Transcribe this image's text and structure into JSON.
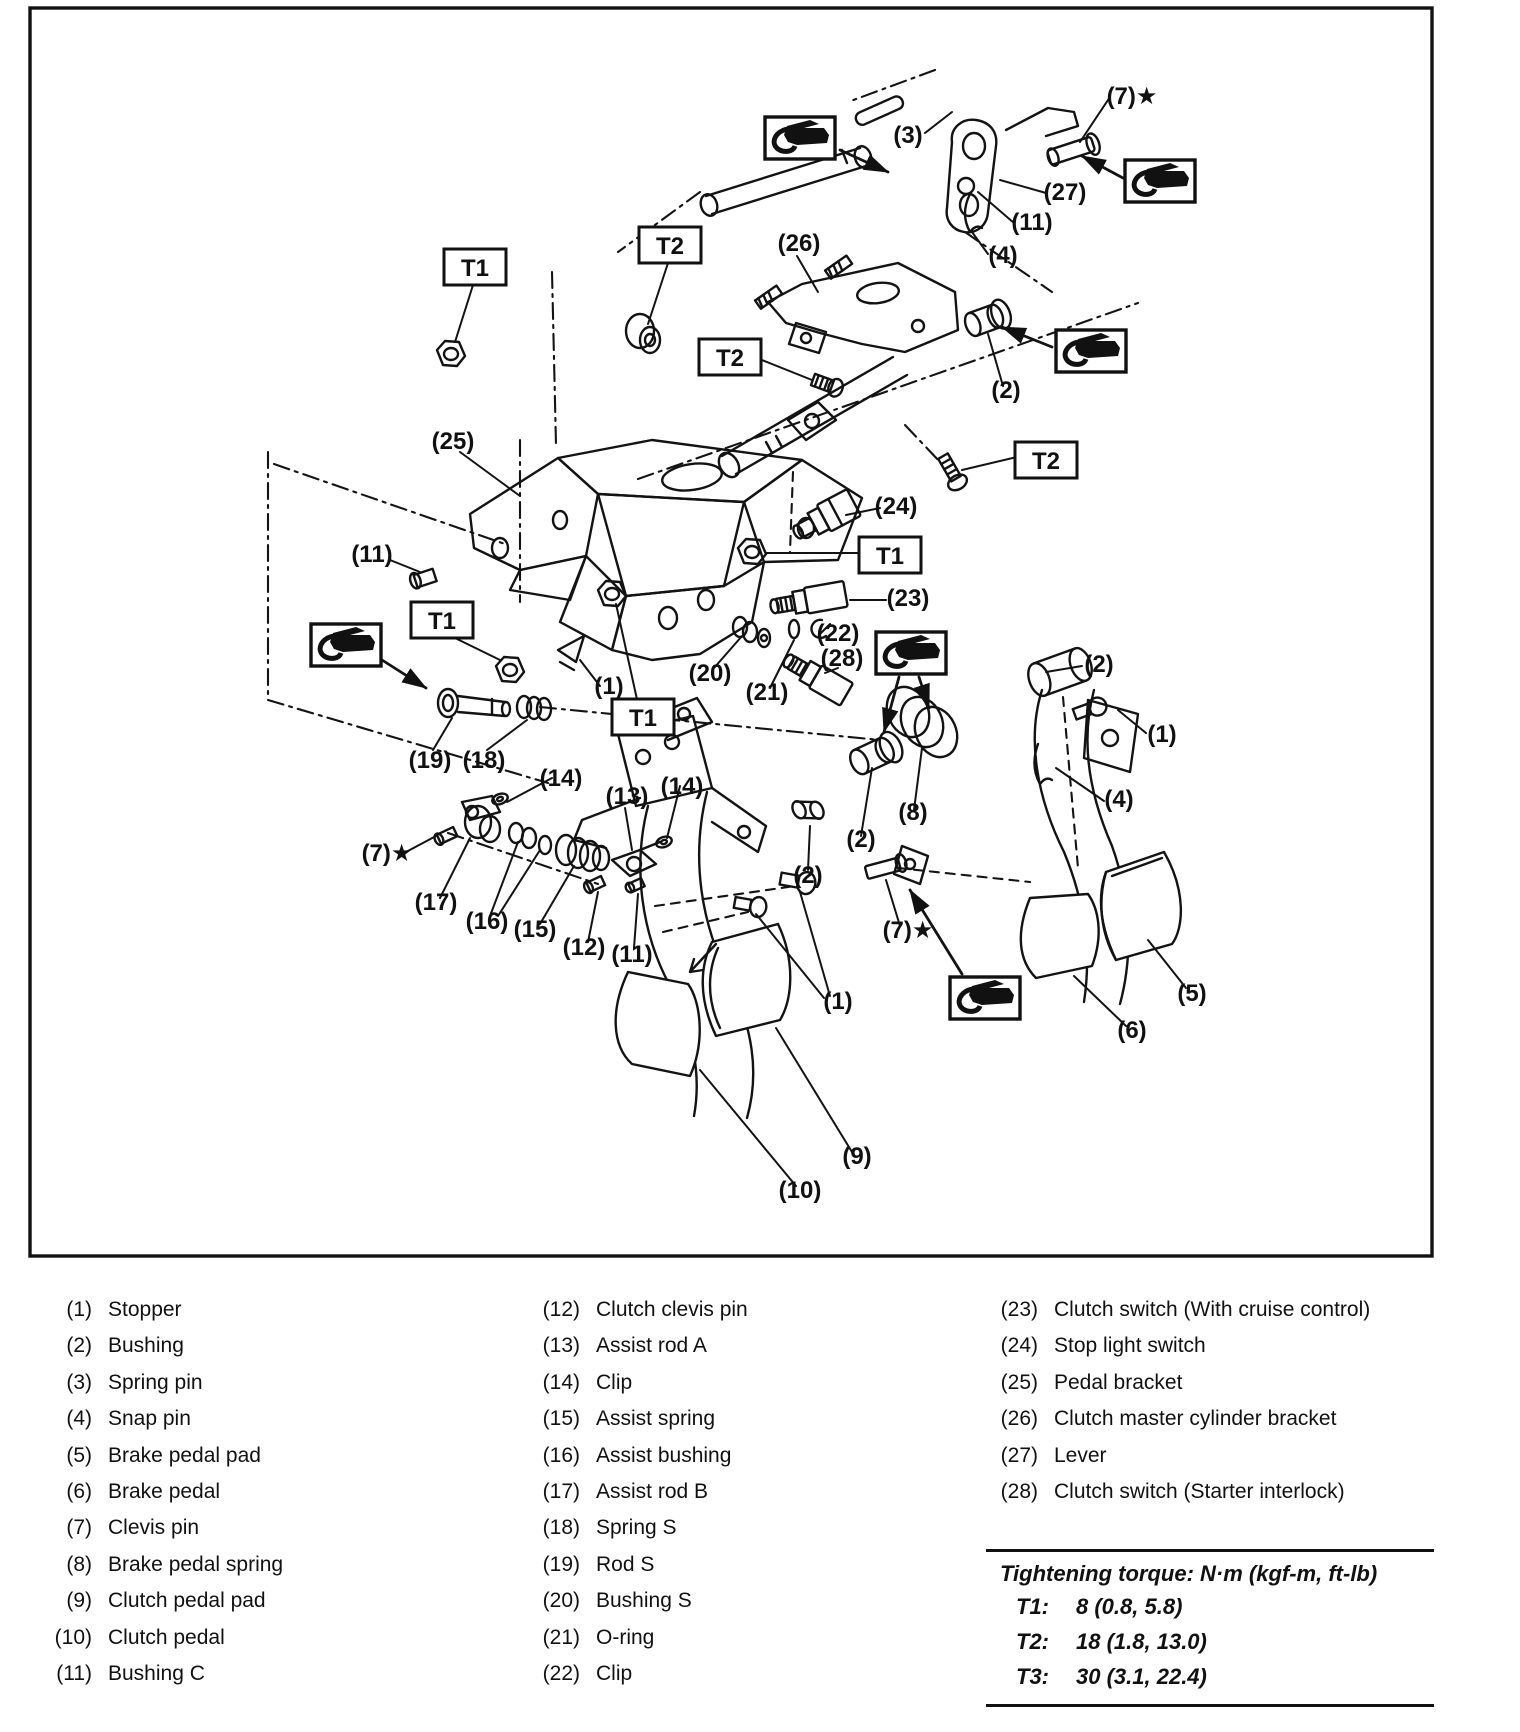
{
  "diagram": {
    "callouts": [
      {
        "text": "(3)",
        "x": 908,
        "y": 143
      },
      {
        "text": "(7)★",
        "x": 1132,
        "y": 104
      },
      {
        "text": "(27)",
        "x": 1065,
        "y": 200
      },
      {
        "text": "(11)",
        "x": 1032,
        "y": 230
      },
      {
        "text": "(4)",
        "x": 1003,
        "y": 263
      },
      {
        "text": "(26)",
        "x": 799,
        "y": 251
      },
      {
        "text": "(2)",
        "x": 1006,
        "y": 398
      },
      {
        "text": "(25)",
        "x": 453,
        "y": 449
      },
      {
        "text": "(24)",
        "x": 896,
        "y": 514
      },
      {
        "text": "(23)",
        "x": 908,
        "y": 606
      },
      {
        "text": "(22)",
        "x": 838,
        "y": 641
      },
      {
        "text": "(28)",
        "x": 842,
        "y": 666
      },
      {
        "text": "(20)",
        "x": 710,
        "y": 681
      },
      {
        "text": "(21)",
        "x": 767,
        "y": 700
      },
      {
        "text": "(2)",
        "x": 1099,
        "y": 672
      },
      {
        "text": "(1)",
        "x": 1162,
        "y": 742
      },
      {
        "text": "(4)",
        "x": 1119,
        "y": 807
      },
      {
        "text": "(11)",
        "x": 372,
        "y": 562
      },
      {
        "text": "(1)",
        "x": 609,
        "y": 694
      },
      {
        "text": "(19)",
        "x": 430,
        "y": 768
      },
      {
        "text": "(18)",
        "x": 484,
        "y": 768
      },
      {
        "text": "(14)",
        "x": 561,
        "y": 786
      },
      {
        "text": "(13)",
        "x": 627,
        "y": 804
      },
      {
        "text": "(14)",
        "x": 682,
        "y": 794
      },
      {
        "text": "(7)★",
        "x": 387,
        "y": 861
      },
      {
        "text": "(17)",
        "x": 436,
        "y": 910
      },
      {
        "text": "(16)",
        "x": 487,
        "y": 929
      },
      {
        "text": "(15)",
        "x": 535,
        "y": 937
      },
      {
        "text": "(12)",
        "x": 584,
        "y": 955
      },
      {
        "text": "(11)",
        "x": 632,
        "y": 962
      },
      {
        "text": "(2)",
        "x": 861,
        "y": 847
      },
      {
        "text": "(8)",
        "x": 913,
        "y": 820
      },
      {
        "text": "(2)",
        "x": 808,
        "y": 883
      },
      {
        "text": "(7)★",
        "x": 908,
        "y": 938
      },
      {
        "text": "(1)",
        "x": 838,
        "y": 1009
      },
      {
        "text": "(9)",
        "x": 857,
        "y": 1164
      },
      {
        "text": "(10)",
        "x": 800,
        "y": 1198
      },
      {
        "text": "(6)",
        "x": 1132,
        "y": 1038
      },
      {
        "text": "(5)",
        "x": 1192,
        "y": 1001
      }
    ],
    "torque_boxes": [
      {
        "label": "T1",
        "x": 475,
        "y": 267
      },
      {
        "label": "T2",
        "x": 670,
        "y": 245
      },
      {
        "label": "T2",
        "x": 730,
        "y": 357
      },
      {
        "label": "T2",
        "x": 1046,
        "y": 460
      },
      {
        "label": "T1",
        "x": 890,
        "y": 555
      },
      {
        "label": "T1",
        "x": 442,
        "y": 620
      },
      {
        "label": "T1",
        "x": 643,
        "y": 717
      }
    ],
    "grease_icons": [
      {
        "x": 763,
        "y": 115
      },
      {
        "x": 1123,
        "y": 158
      },
      {
        "x": 1054,
        "y": 328
      },
      {
        "x": 874,
        "y": 630
      },
      {
        "x": 309,
        "y": 622
      },
      {
        "x": 948,
        "y": 975
      }
    ]
  },
  "parts": {
    "col1": [
      {
        "num": "(1)",
        "name": "Stopper"
      },
      {
        "num": "(2)",
        "name": "Bushing"
      },
      {
        "num": "(3)",
        "name": "Spring pin"
      },
      {
        "num": "(4)",
        "name": "Snap pin"
      },
      {
        "num": "(5)",
        "name": "Brake pedal pad"
      },
      {
        "num": "(6)",
        "name": "Brake pedal"
      },
      {
        "num": "(7)",
        "name": "Clevis pin"
      },
      {
        "num": "(8)",
        "name": "Brake pedal spring"
      },
      {
        "num": "(9)",
        "name": "Clutch pedal pad"
      },
      {
        "num": "(10)",
        "name": "Clutch pedal"
      },
      {
        "num": "(11)",
        "name": "Bushing C"
      }
    ],
    "col2": [
      {
        "num": "(12)",
        "name": "Clutch clevis pin"
      },
      {
        "num": "(13)",
        "name": "Assist rod A"
      },
      {
        "num": "(14)",
        "name": "Clip"
      },
      {
        "num": "(15)",
        "name": "Assist spring"
      },
      {
        "num": "(16)",
        "name": "Assist bushing"
      },
      {
        "num": "(17)",
        "name": "Assist rod B"
      },
      {
        "num": "(18)",
        "name": "Spring S"
      },
      {
        "num": "(19)",
        "name": "Rod S"
      },
      {
        "num": "(20)",
        "name": "Bushing S"
      },
      {
        "num": "(21)",
        "name": "O-ring"
      },
      {
        "num": "(22)",
        "name": "Clip"
      }
    ],
    "col3": [
      {
        "num": "(23)",
        "name": "Clutch switch (With cruise control)"
      },
      {
        "num": "(24)",
        "name": "Stop light switch"
      },
      {
        "num": "(25)",
        "name": "Pedal bracket"
      },
      {
        "num": "(26)",
        "name": "Clutch master cylinder bracket"
      },
      {
        "num": "(27)",
        "name": "Lever"
      },
      {
        "num": "(28)",
        "name": "Clutch switch (Starter interlock)"
      }
    ]
  },
  "torque_table": {
    "title": "Tightening torque: N·m (kgf-m, ft-lb)",
    "rows": [
      {
        "id": "T1:",
        "value": "8 (0.8, 5.8)"
      },
      {
        "id": "T2:",
        "value": "18 (1.8, 13.0)"
      },
      {
        "id": "T3:",
        "value": "30 (3.1, 22.4)"
      }
    ]
  }
}
